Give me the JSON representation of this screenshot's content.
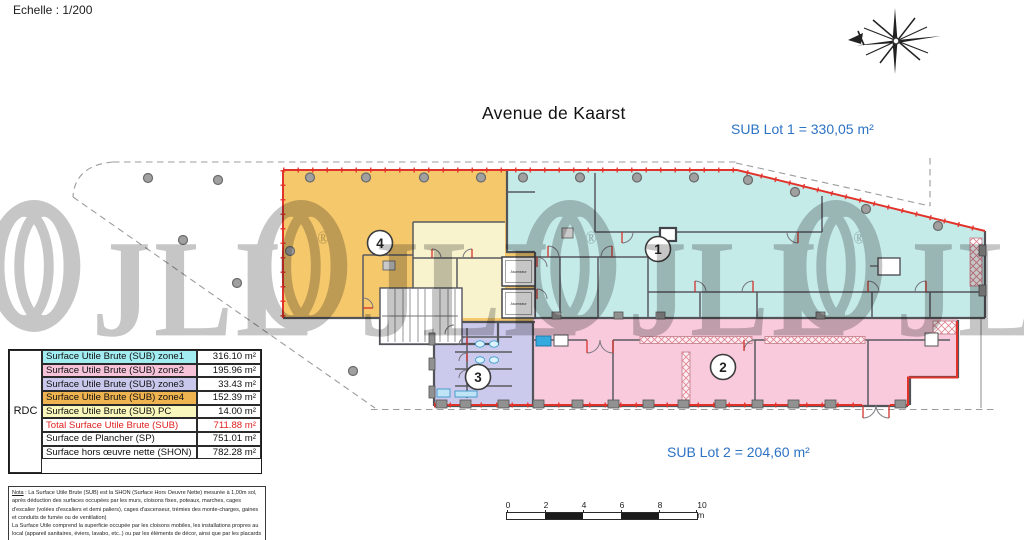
{
  "meta": {
    "scale_label": "Echelle : 1/200"
  },
  "plan": {
    "street_label": "Avenue de Kaarst",
    "lot1_label": "SUB Lot 1 = 330,05 m²",
    "lot2_label": "SUB Lot 2 = 204,60 m²",
    "markers": [
      "1",
      "2",
      "3",
      "4"
    ],
    "elevator_label": "Ascenseur",
    "colors": {
      "zone1_cyan": "#c5ebe9",
      "zone2_pink": "#f8cadb",
      "zone3_purple": "#cbc9ec",
      "zone4_yellow": "#f5c86c",
      "pc_pale_yellow": "#f8f3cd",
      "boundary_red": "#e2332b",
      "wall_gray": "#53535a",
      "label_blue": "#2d73c4",
      "watermark_gray": "#c6c6c6"
    }
  },
  "table": {
    "row_header": "RDC",
    "rows": [
      {
        "label": "Surface Utile Brute (SUB) zone1",
        "value": "316.10 m²"
      },
      {
        "label": "Surface Utile Brute (SUB) zone2",
        "value": "195.96 m²"
      },
      {
        "label": "Surface Utile Brute (SUB) zone3",
        "value": "33.43 m²"
      },
      {
        "label": "Surface Utile Brute (SUB) zone4",
        "value": "152.39 m²"
      },
      {
        "label": "Surface Utile Brute (SUB) PC",
        "value": "14.00 m²"
      },
      {
        "label": "Total Surface Utile Brute (SUB)",
        "value": "711.88 m²"
      },
      {
        "label": "Surface de Plancher (SP)",
        "value": "751.01 m²"
      },
      {
        "label": "Surface hors œuvre nette (SHON)",
        "value": "782.28 m²"
      }
    ]
  },
  "nota": {
    "title": "Nota",
    "p1": " : La Surface Utile Brute (SUB) est la SHON (Surface Hors Oeuvre Nette) mesurée à 1,00m sol, après déduction des surfaces occupées par les murs, cloisons fixes, poteaux, marches, cages d'escalier (volées d'escaliers et demi paliers), cages d'ascenseur, trémies des monte-charges, gaines et conduits de fumée ou de ventilation)",
    "p2": "La Surface Utile comprend la superficie occupée par les cloisons mobiles, les installations propres au local (appareil sanitaires, éviers, lavabo, etc..) ou par les éléments de décor, ainsi que par les placards situés en saillie ou non des murs ou des cloisons proprement dit."
  },
  "scalebar": {
    "ticks": [
      "0",
      "2",
      "4",
      "6",
      "8",
      "10 m"
    ]
  },
  "watermark": {
    "text": "JLL",
    "reg": "®"
  }
}
